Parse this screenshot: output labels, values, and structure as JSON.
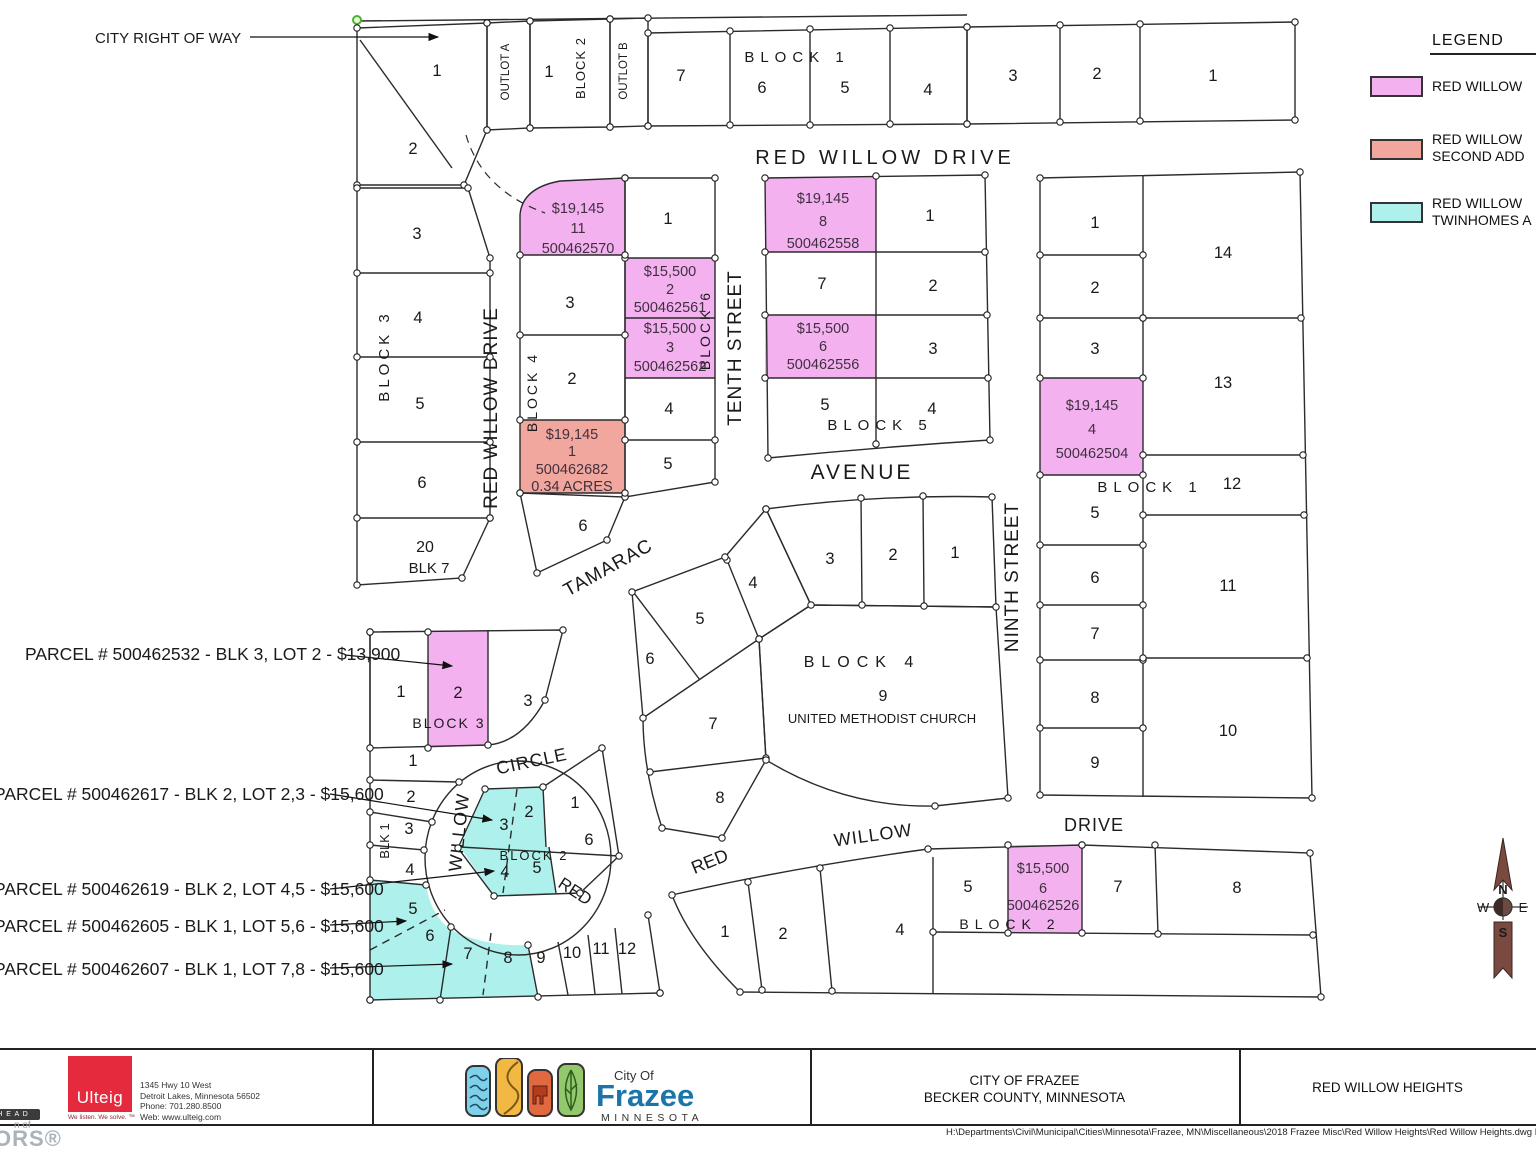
{
  "colors": {
    "pink": "#f3b1f0",
    "salmon": "#f1a79e",
    "cyan": "#aef1ec",
    "line": "#2b2b2b",
    "price_text": "#40303f",
    "label_text": "#1a1a1a",
    "green_node": "#4cb32e",
    "compass": "#7a4a40",
    "frazee_blue": "#1b75a8",
    "ulteig_red": "#e62a3e"
  },
  "legend": {
    "title": "LEGEND",
    "items": [
      {
        "swatch": "pink",
        "label_lines": [
          "RED WILLOW",
          ""
        ]
      },
      {
        "swatch": "salmon",
        "label_lines": [
          "RED WILLOW",
          "SECOND ADD"
        ]
      },
      {
        "swatch": "cyan",
        "label_lines": [
          "RED WILLOW",
          "TWINHOMES A"
        ]
      }
    ]
  },
  "map": {
    "street_labels": [
      {
        "t": "RED WILLOW DRIVE",
        "x": 885,
        "y": 164,
        "s": 20,
        "ls": 4,
        "n": "street-red-willow-drive-top"
      },
      {
        "t": "RED WILLOW DRIVE",
        "x": 497,
        "y": 408,
        "s": 19,
        "ls": 1,
        "r": -90,
        "n": "street-red-willow-drive-west"
      },
      {
        "t": "TENTH STREET",
        "x": 741,
        "y": 348,
        "s": 19,
        "ls": 1,
        "r": -90,
        "n": "street-tenth"
      },
      {
        "t": "NINTH STREET",
        "x": 1018,
        "y": 577,
        "s": 19,
        "ls": 1,
        "r": -90,
        "n": "street-ninth"
      },
      {
        "t": "AVENUE",
        "x": 862,
        "y": 479,
        "s": 21,
        "ls": 3,
        "n": "street-avenue"
      },
      {
        "t": "TAMARAC",
        "x": 611,
        "y": 573,
        "s": 19,
        "ls": 1,
        "r": -29,
        "n": "street-tamarac"
      },
      {
        "t": "CIRCLE",
        "x": 533,
        "y": 767,
        "s": 18,
        "ls": 1,
        "r": -12,
        "n": "street-circle"
      },
      {
        "t": "WILLOW",
        "x": 465,
        "y": 833,
        "s": 18,
        "ls": 1,
        "r": -84,
        "n": "street-willow-west"
      },
      {
        "t": "RED",
        "x": 572,
        "y": 896,
        "s": 17,
        "r": 33,
        "n": "street-red-circle"
      },
      {
        "t": "RED",
        "x": 712,
        "y": 867,
        "s": 18,
        "r": -22,
        "n": "street-red-bottom"
      },
      {
        "t": "WILLOW",
        "x": 874,
        "y": 841,
        "s": 18,
        "ls": 1,
        "r": -8,
        "n": "street-willow-bottom"
      },
      {
        "t": "DRIVE",
        "x": 1094,
        "y": 831,
        "s": 18,
        "ls": 1,
        "n": "street-drive-bottom"
      }
    ],
    "block_labels": [
      {
        "t": "BLOCK 1",
        "x": 797,
        "y": 62,
        "s": 15,
        "ls": 6,
        "n": "block1-top-label"
      },
      {
        "t": "BLOCK 2",
        "x": 585,
        "y": 68,
        "s": 13,
        "ls": 1,
        "r": -90,
        "n": "block2-top-label"
      },
      {
        "t": "OUTLOT A",
        "x": 509,
        "y": 72,
        "s": 11.5,
        "r": -90,
        "n": "outlot-a-label"
      },
      {
        "t": "OUTLOT B",
        "x": 627,
        "y": 71,
        "s": 11.5,
        "r": -90,
        "n": "outlot-b-label"
      },
      {
        "t": "BLOCK 3",
        "x": 389,
        "y": 356,
        "s": 15,
        "ls": 4,
        "r": -90,
        "n": "block3-west-label"
      },
      {
        "t": "BLOCK 4",
        "x": 537,
        "y": 392,
        "s": 14,
        "ls": 3,
        "r": -90,
        "n": "block4-west-label"
      },
      {
        "t": "BLOCK 6",
        "x": 710,
        "y": 330,
        "s": 14,
        "ls": 3,
        "r": -90,
        "n": "block6-label"
      },
      {
        "t": "BLOCK 5",
        "x": 880,
        "y": 430,
        "s": 15,
        "ls": 6,
        "n": "block5-label"
      },
      {
        "t": "BLOCK 1",
        "x": 1150,
        "y": 492,
        "s": 15,
        "ls": 6,
        "n": "block1-east-label"
      },
      {
        "t": "BLOCK 4",
        "x": 862,
        "y": 667,
        "s": 16,
        "ls": 7,
        "n": "block4-center-label"
      },
      {
        "t": "9",
        "x": 883,
        "y": 701,
        "s": 16,
        "n": "church-lot-number"
      },
      {
        "t": "UNITED METHODIST CHURCH",
        "x": 882,
        "y": 723,
        "s": 13,
        "n": "church-name-label"
      },
      {
        "t": "BLOCK 3",
        "x": 449,
        "y": 728,
        "s": 14,
        "ls": 2,
        "n": "block3-south-label"
      },
      {
        "t": "BLK 1",
        "x": 389,
        "y": 841,
        "s": 13,
        "r": -90,
        "n": "blk1-south-label"
      },
      {
        "t": "BLOCK 2",
        "x": 534,
        "y": 860,
        "s": 13,
        "ls": 2,
        "n": "block2-island-label"
      },
      {
        "t": "BLOCK 2",
        "x": 1010,
        "y": 929,
        "s": 14,
        "ls": 6,
        "n": "block2-bottom-label"
      },
      {
        "t": "20",
        "x": 425,
        "y": 552,
        "s": 16,
        "n": "lot20-label"
      },
      {
        "t": "BLK 7",
        "x": 429,
        "y": 573,
        "s": 15,
        "n": "blk7-label"
      }
    ],
    "lot_numbers": [
      {
        "t": "1",
        "x": 437,
        "y": 76
      },
      {
        "t": "2",
        "x": 413,
        "y": 154
      },
      {
        "t": "1",
        "x": 549,
        "y": 77
      },
      {
        "t": "7",
        "x": 681,
        "y": 81
      },
      {
        "t": "6",
        "x": 762,
        "y": 93
      },
      {
        "t": "5",
        "x": 845,
        "y": 93
      },
      {
        "t": "4",
        "x": 928,
        "y": 95
      },
      {
        "t": "3",
        "x": 1013,
        "y": 81
      },
      {
        "t": "2",
        "x": 1097,
        "y": 79
      },
      {
        "t": "1",
        "x": 1213,
        "y": 81
      },
      {
        "t": "3",
        "x": 417,
        "y": 239
      },
      {
        "t": "4",
        "x": 418,
        "y": 323
      },
      {
        "t": "5",
        "x": 420,
        "y": 409
      },
      {
        "t": "6",
        "x": 422,
        "y": 488
      },
      {
        "t": "3",
        "x": 570,
        "y": 308
      },
      {
        "t": "2",
        "x": 572,
        "y": 384
      },
      {
        "t": "1",
        "x": 668,
        "y": 224
      },
      {
        "t": "4",
        "x": 669,
        "y": 414
      },
      {
        "t": "5",
        "x": 668,
        "y": 469
      },
      {
        "t": "6",
        "x": 583,
        "y": 531
      },
      {
        "t": "1",
        "x": 930,
        "y": 221
      },
      {
        "t": "7",
        "x": 822,
        "y": 289
      },
      {
        "t": "2",
        "x": 933,
        "y": 291
      },
      {
        "t": "3",
        "x": 933,
        "y": 354
      },
      {
        "t": "5",
        "x": 825,
        "y": 410
      },
      {
        "t": "4",
        "x": 932,
        "y": 414
      },
      {
        "t": "1",
        "x": 1095,
        "y": 228
      },
      {
        "t": "2",
        "x": 1095,
        "y": 293
      },
      {
        "t": "3",
        "x": 1095,
        "y": 354
      },
      {
        "t": "5",
        "x": 1095,
        "y": 518
      },
      {
        "t": "6",
        "x": 1095,
        "y": 583
      },
      {
        "t": "7",
        "x": 1095,
        "y": 639
      },
      {
        "t": "8",
        "x": 1095,
        "y": 703
      },
      {
        "t": "9",
        "x": 1095,
        "y": 768
      },
      {
        "t": "14",
        "x": 1223,
        "y": 258
      },
      {
        "t": "13",
        "x": 1223,
        "y": 388
      },
      {
        "t": "12",
        "x": 1232,
        "y": 489
      },
      {
        "t": "11",
        "x": 1228,
        "y": 591
      },
      {
        "t": "10",
        "x": 1228,
        "y": 736
      },
      {
        "t": "3",
        "x": 830,
        "y": 564
      },
      {
        "t": "2",
        "x": 893,
        "y": 560
      },
      {
        "t": "1",
        "x": 955,
        "y": 558
      },
      {
        "t": "4",
        "x": 753,
        "y": 588
      },
      {
        "t": "5",
        "x": 700,
        "y": 624
      },
      {
        "t": "6",
        "x": 650,
        "y": 664
      },
      {
        "t": "7",
        "x": 713,
        "y": 729
      },
      {
        "t": "8",
        "x": 720,
        "y": 803
      },
      {
        "t": "1",
        "x": 401,
        "y": 697
      },
      {
        "t": "2",
        "x": 458,
        "y": 698
      },
      {
        "t": "3",
        "x": 528,
        "y": 706
      },
      {
        "t": "1",
        "x": 413,
        "y": 766
      },
      {
        "t": "2",
        "x": 411,
        "y": 802
      },
      {
        "t": "3",
        "x": 409,
        "y": 834
      },
      {
        "t": "4",
        "x": 410,
        "y": 875
      },
      {
        "t": "5",
        "x": 413,
        "y": 914
      },
      {
        "t": "6",
        "x": 430,
        "y": 941
      },
      {
        "t": "7",
        "x": 468,
        "y": 959
      },
      {
        "t": "8",
        "x": 508,
        "y": 963
      },
      {
        "t": "9",
        "x": 541,
        "y": 963
      },
      {
        "t": "10",
        "x": 572,
        "y": 958
      },
      {
        "t": "11",
        "x": 601,
        "y": 954
      },
      {
        "t": "12",
        "x": 627,
        "y": 954
      },
      {
        "t": "3",
        "x": 504,
        "y": 830
      },
      {
        "t": "2",
        "x": 529,
        "y": 817
      },
      {
        "t": "1",
        "x": 575,
        "y": 808
      },
      {
        "t": "6",
        "x": 589,
        "y": 845
      },
      {
        "t": "4",
        "x": 505,
        "y": 877
      },
      {
        "t": "5",
        "x": 537,
        "y": 873
      },
      {
        "t": "1",
        "x": 725,
        "y": 937
      },
      {
        "t": "2",
        "x": 783,
        "y": 939
      },
      {
        "t": "4",
        "x": 900,
        "y": 935
      },
      {
        "t": "5",
        "x": 968,
        "y": 892
      },
      {
        "t": "7",
        "x": 1118,
        "y": 892
      },
      {
        "t": "8",
        "x": 1237,
        "y": 893
      }
    ],
    "parcel_price_labels": [
      {
        "t": "$19,145",
        "x": 578,
        "y": 213,
        "n": "price-500462570"
      },
      {
        "t": "11",
        "x": 578,
        "y": 233,
        "n": "price-500462570"
      },
      {
        "t": "500462570",
        "x": 578,
        "y": 253,
        "n": "price-500462570"
      },
      {
        "t": "$15,500",
        "x": 670,
        "y": 276,
        "n": "price-500462561"
      },
      {
        "t": "2",
        "x": 670,
        "y": 294,
        "n": "price-500462561"
      },
      {
        "t": "500462561",
        "x": 670,
        "y": 312,
        "n": "price-500462561"
      },
      {
        "t": "$15,500",
        "x": 670,
        "y": 333,
        "n": "price-500462562"
      },
      {
        "t": "3",
        "x": 670,
        "y": 352,
        "n": "price-500462562"
      },
      {
        "t": "500462562",
        "x": 670,
        "y": 371,
        "n": "price-500462562"
      },
      {
        "t": "$19,145",
        "x": 572,
        "y": 439,
        "n": "price-500462682"
      },
      {
        "t": "1",
        "x": 572,
        "y": 456,
        "n": "price-500462682"
      },
      {
        "t": "500462682",
        "x": 572,
        "y": 474,
        "n": "price-500462682"
      },
      {
        "t": "0.34  ACRES",
        "x": 572,
        "y": 491,
        "n": "price-500462682"
      },
      {
        "t": "$19,145",
        "x": 823,
        "y": 203,
        "n": "price-500462558"
      },
      {
        "t": "8",
        "x": 823,
        "y": 226,
        "n": "price-500462558"
      },
      {
        "t": "500462558",
        "x": 823,
        "y": 248,
        "n": "price-500462558"
      },
      {
        "t": "$15,500",
        "x": 823,
        "y": 333,
        "n": "price-500462556"
      },
      {
        "t": "6",
        "x": 823,
        "y": 351,
        "n": "price-500462556"
      },
      {
        "t": "500462556",
        "x": 823,
        "y": 369,
        "n": "price-500462556"
      },
      {
        "t": "$19,145",
        "x": 1092,
        "y": 410,
        "n": "price-500462504"
      },
      {
        "t": "4",
        "x": 1092,
        "y": 434,
        "n": "price-500462504"
      },
      {
        "t": "500462504",
        "x": 1092,
        "y": 458,
        "n": "price-500462504"
      },
      {
        "t": "$15,500",
        "x": 1043,
        "y": 873,
        "n": "price-500462526"
      },
      {
        "t": "6",
        "x": 1043,
        "y": 893,
        "n": "price-500462526"
      },
      {
        "t": "500462526",
        "x": 1043,
        "y": 910,
        "n": "price-500462526"
      }
    ],
    "callouts": [
      {
        "t": "CITY RIGHT OF WAY",
        "x": 95,
        "y": 43,
        "s": 15,
        "n": "callout-city-right-of-way"
      },
      {
        "t": "PARCEL # 500462532 - BLK 3, LOT 2 - $13,900",
        "x": 25,
        "y": 660,
        "s": 17.5,
        "n": "callout-parcel-500462532"
      },
      {
        "t": "PARCEL # 500462617 - BLK 2, LOT 2,3 - $15,600",
        "x": -6,
        "y": 800,
        "s": 17.5,
        "n": "callout-parcel-500462617"
      },
      {
        "t": "PARCEL # 500462619 - BLK 2, LOT 4,5 - $15,600",
        "x": -6,
        "y": 895,
        "s": 17.5,
        "n": "callout-parcel-500462619"
      },
      {
        "t": "PARCEL # 500462605 - BLK 1, LOT 5,6 - $15,600",
        "x": -6,
        "y": 932,
        "s": 17.5,
        "n": "callout-parcel-500462605"
      },
      {
        "t": "PARCEL # 500462607 - BLK 1, LOT 7,8 - $15,600",
        "x": -6,
        "y": 975,
        "s": 17.5,
        "n": "callout-parcel-500462607"
      }
    ]
  },
  "compass": {
    "n": "N",
    "w": "W",
    "e": "E",
    "s": "S"
  },
  "footer": {
    "ulteig": {
      "name": "Ulteig",
      "tagline": "We listen. We solve. ™",
      "address_lines": [
        "1345 Hwy 10 West",
        "Detroit Lakes, Minnesota  56502",
        "Phone:  701.280.8500",
        "Web:  www.ulteig.com"
      ]
    },
    "frazee": {
      "city_of": "City Of",
      "name": "Frazee",
      "state": "MINNESOTA"
    },
    "county_panel": {
      "line1": "CITY OF FRAZEE",
      "line2": "BECKER COUNTY, MINNESOTA"
    },
    "title_panel": "RED WILLOW HEIGHTS",
    "file_path": "H:\\Departments\\Civil\\Municipal\\Cities\\Minnesota\\Frazee, MN\\Miscellaneous\\2018 Frazee Misc\\Red Willow Heights\\Red Willow Heights.dwg L"
  },
  "watermark": {
    "bar": "H E A D",
    "mid": "n of",
    "big": "ORS®"
  }
}
